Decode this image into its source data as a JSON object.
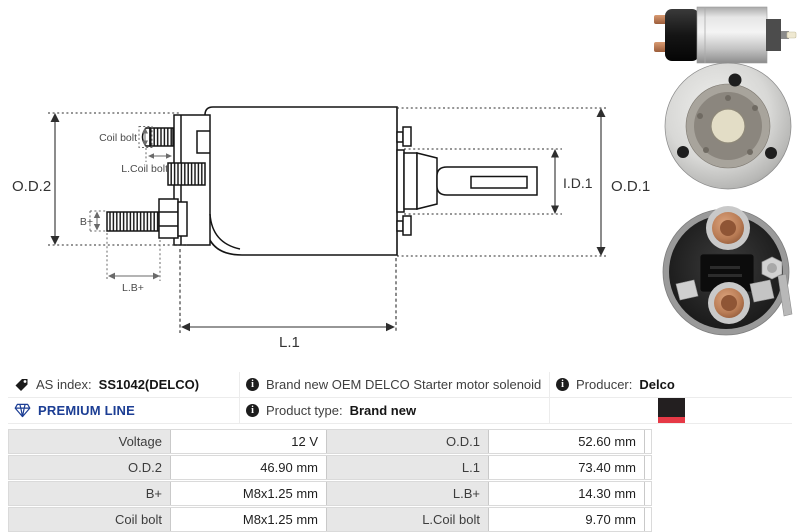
{
  "diagram": {
    "od2": "O.D.2",
    "od1": "O.D.1",
    "id1": "I.D.1",
    "l1": "L.1",
    "coil_bolt": "Coil bolt",
    "l_coil_bolt": "L.Coil bolt",
    "b_plus": "B+",
    "l_b_plus": "L.B+"
  },
  "photos": [
    {
      "name": "solenoid-side-view"
    },
    {
      "name": "solenoid-front-face"
    },
    {
      "name": "solenoid-terminal-face"
    }
  ],
  "info": {
    "as_index": {
      "label": "AS index:",
      "value": "SS1042(DELCO)"
    },
    "description": "Brand new OEM DELCO Starter motor solenoid",
    "producer": {
      "label": "Producer:",
      "value": "Delco"
    },
    "premium_line": "PREMIUM LINE",
    "product_type": {
      "label": "Product type:",
      "value": "Brand new"
    },
    "icons": {
      "as_index": "tag-icon",
      "description": "info-icon",
      "producer": "info-icon",
      "premium": "diamond-icon",
      "product_type": "info-icon",
      "brand_logo": "black-red-brand-logo"
    }
  },
  "colors": {
    "premium_blue": "#1c3e94",
    "logo_black": "#231f20",
    "logo_red": "#e63946",
    "table_label_bg": "#e7e7e7",
    "copper": "#b97c55"
  },
  "spec_table": {
    "rows": [
      {
        "label1": "Voltage",
        "value1": "12 V",
        "label2": "O.D.1",
        "value2": "52.60 mm"
      },
      {
        "label1": "O.D.2",
        "value1": "46.90 mm",
        "label2": "L.1",
        "value2": "73.40 mm"
      },
      {
        "label1": "B+",
        "value1": "M8x1.25 mm",
        "label2": "L.B+",
        "value2": "14.30 mm"
      },
      {
        "label1": "Coil bolt",
        "value1": "M8x1.25 mm",
        "label2": "L.Coil bolt",
        "value2": "9.70 mm"
      }
    ]
  }
}
